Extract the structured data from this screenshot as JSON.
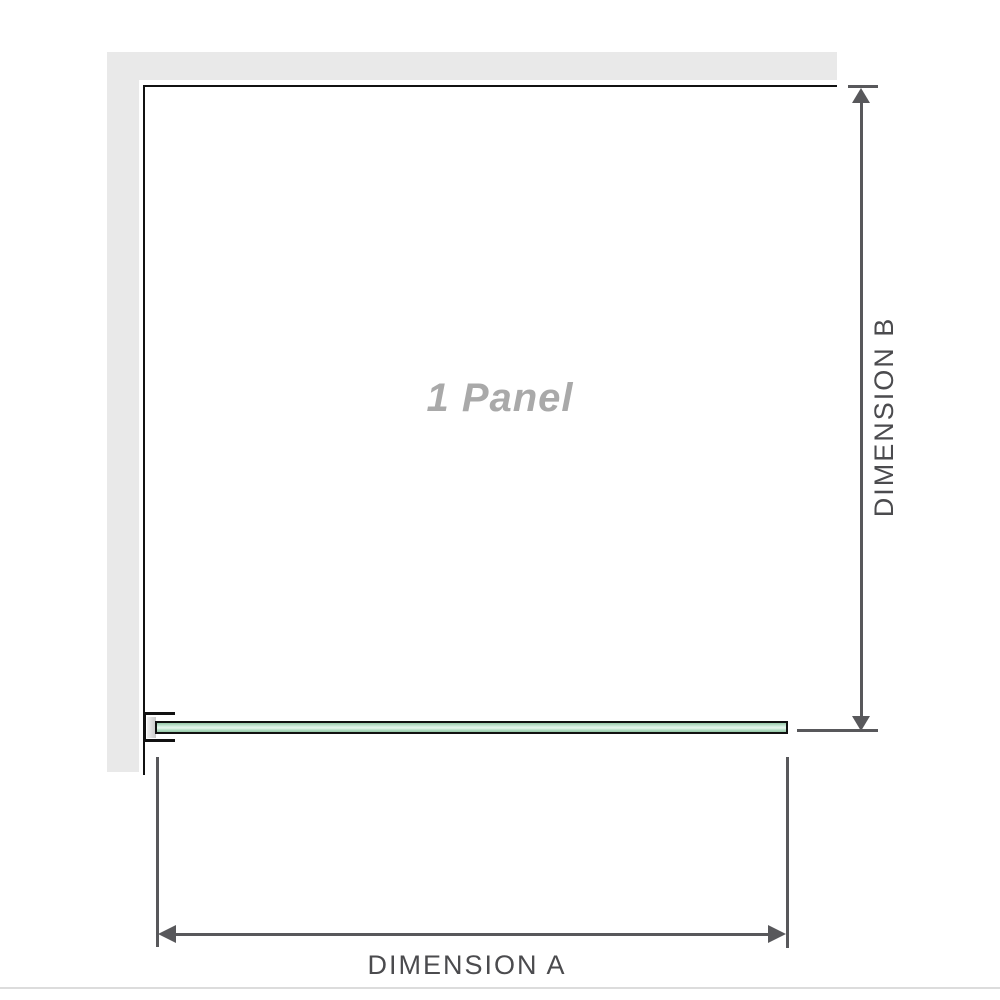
{
  "labels": {
    "panel": "1 Panel",
    "dimension_a": "DIMENSION A",
    "dimension_b": "DIMENSION B"
  },
  "colors": {
    "wall_gray": "#e9e9e9",
    "outline_black": "#111111",
    "dimension_line_gray": "#58585b",
    "dimension_text_gray": "#4b4b4e",
    "panel_label_gray": "#a9a9a9",
    "glass_green_light": "#e8f7ee",
    "glass_green_dark": "#96c8a7",
    "bracket_pad_gray": "#c9c9c9",
    "baseline_gray": "#dcdcdc"
  }
}
